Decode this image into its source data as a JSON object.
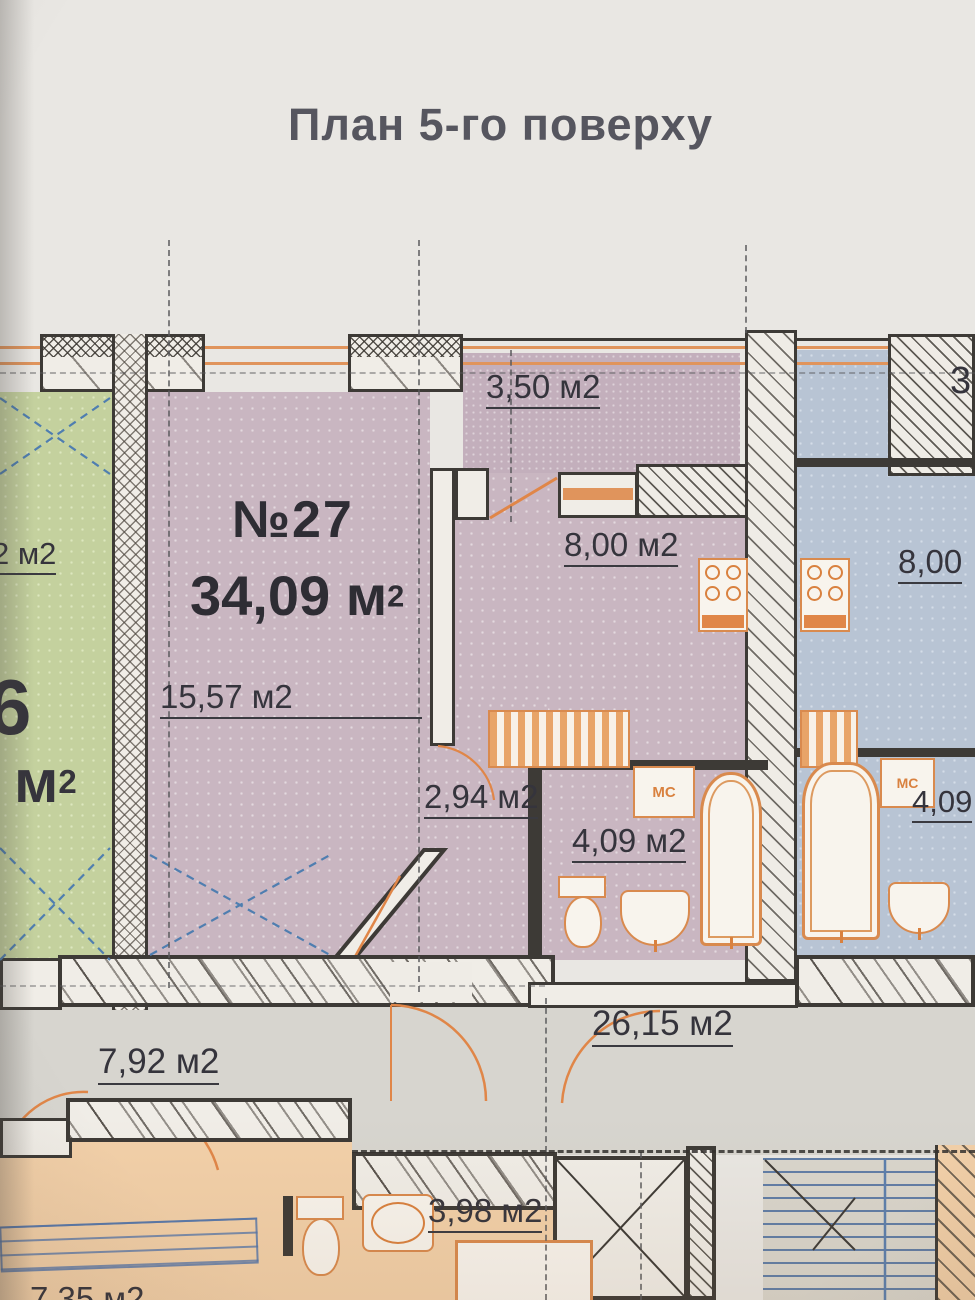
{
  "title": "План 5-го поверху",
  "plan": {
    "apartment27": {
      "number": "№27",
      "total_area": "34,09 м",
      "total_area_sup": "2",
      "living_room_area": "15,57 м2",
      "balcony_area": "3,50 м2",
      "kitchen_area": "8,00 м2",
      "hall_area": "2,94 м2",
      "bathroom_area": "4,09 м2"
    },
    "left_apartment": {
      "partial_room_area": "2 м2",
      "partial_total_digit": "6",
      "partial_total_unit": "м",
      "partial_total_unit_sup": "2"
    },
    "right_apartment": {
      "kitchen_area_partial": "8,00",
      "bathroom_area_partial": "4,09",
      "balcony_area_partial": "3"
    },
    "common_areas": {
      "corridor_area": "26,15 м2",
      "entry_hall_area": "7,92 м2",
      "lower_room_area": "3,98 м2",
      "lower_partial_area": "7,35 м2"
    },
    "fixtures": {
      "washer_label": "МС"
    }
  },
  "colors": {
    "wall": "#3d3a36",
    "accent_orange": "#d98a4e",
    "apartment_purple": "#c9b6c1",
    "apartment_green": "#c4d19e",
    "apartment_blue": "#b8c4d4",
    "apartment_orange_lower": "#f2d0a9",
    "corridor_gray": "#d7d5cf",
    "stairs_blue": "#5b7fae",
    "title_text": "#56565f"
  }
}
